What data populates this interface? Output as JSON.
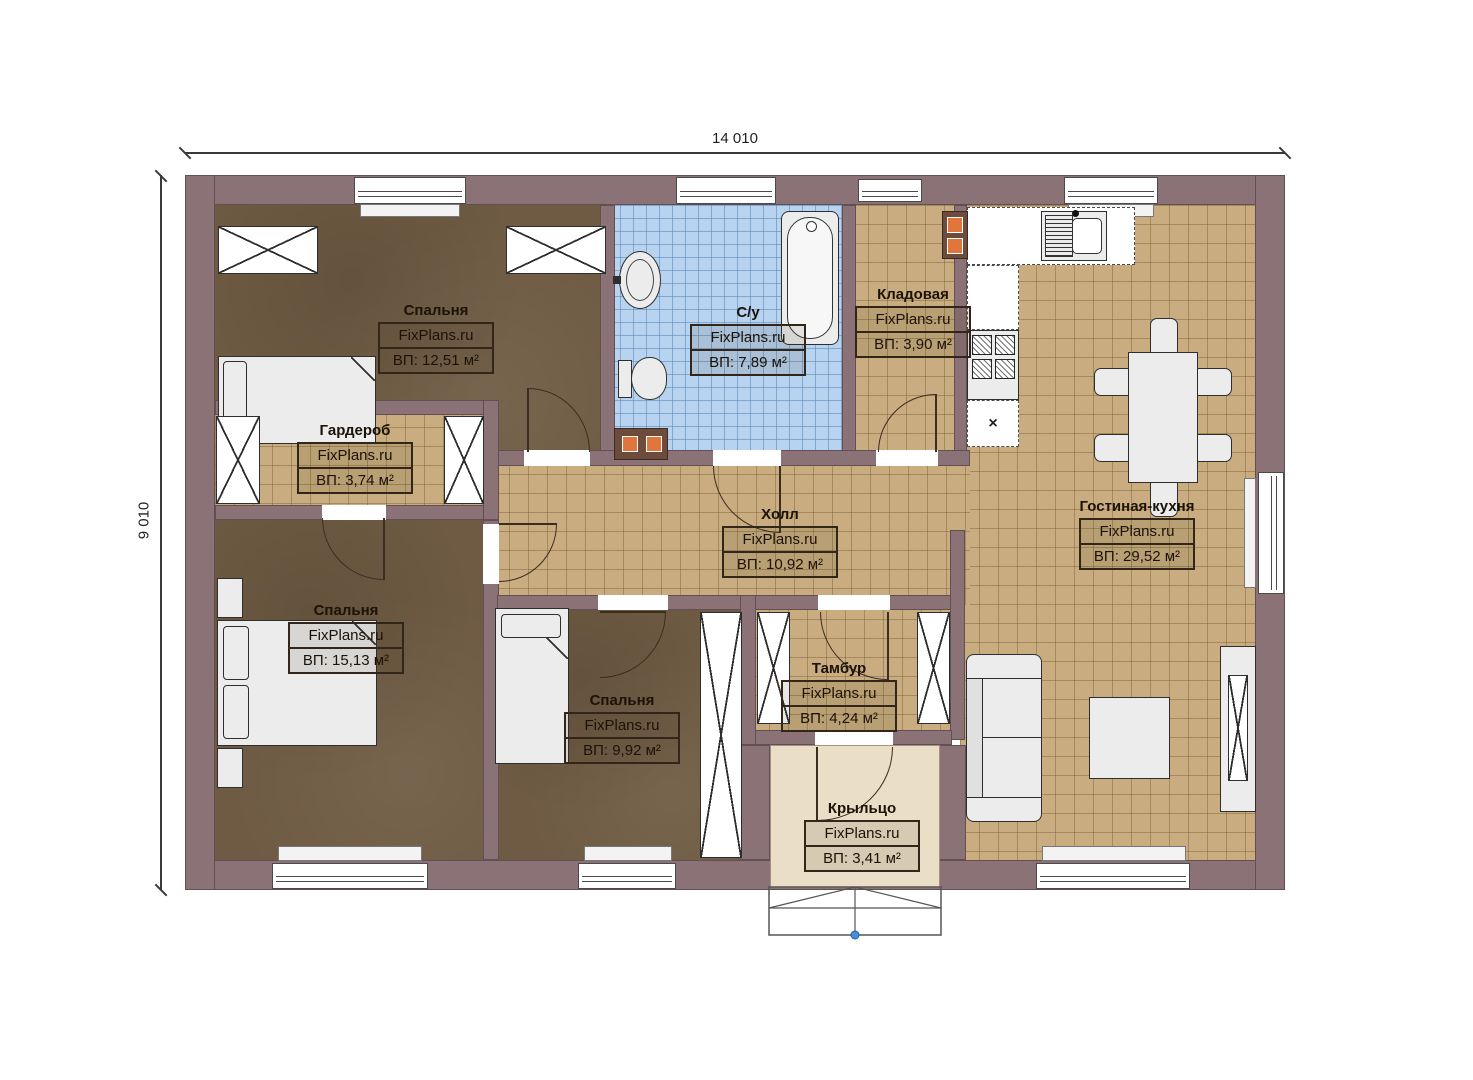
{
  "watermark": "FixPlans.ru",
  "dimensions": {
    "width": "14 010",
    "height": "9 010"
  },
  "rooms": [
    {
      "id": "bedroom-top",
      "name": "Спальня",
      "area": "ВП: 12,51 м²"
    },
    {
      "id": "bathroom",
      "name": "С/у",
      "area": "ВП: 7,89 м²"
    },
    {
      "id": "storage",
      "name": "Кладовая",
      "area": "ВП: 3,90 м²"
    },
    {
      "id": "wardrobe-room",
      "name": "Гардероб",
      "area": "ВП: 3,74 м²"
    },
    {
      "id": "hall",
      "name": "Холл",
      "area": "ВП: 10,92 м²"
    },
    {
      "id": "living-kitchen",
      "name": "Гостиная-кухня",
      "area": "ВП: 29,52 м²"
    },
    {
      "id": "bedroom-left",
      "name": "Спальня",
      "area": "ВП: 15,13 м²"
    },
    {
      "id": "bedroom-mid",
      "name": "Спальня",
      "area": "ВП: 9,92 м²"
    },
    {
      "id": "vestibule",
      "name": "Тамбур",
      "area": "ВП: 4,24 м²"
    },
    {
      "id": "porch",
      "name": "Крыльцо",
      "area": "ВП: 3,41 м²"
    }
  ],
  "markers": {
    "cabinet_x": "×"
  },
  "colors": {
    "wall": "#8b7276",
    "tile_floor": "#c9ad80",
    "bath_tile": "#b7d3ef",
    "bedroom_floor": "#6f5b43",
    "porch_floor": "#ebdec6",
    "accent_orange": "#e0763c",
    "step_dot_blue": "#4a90d9"
  }
}
